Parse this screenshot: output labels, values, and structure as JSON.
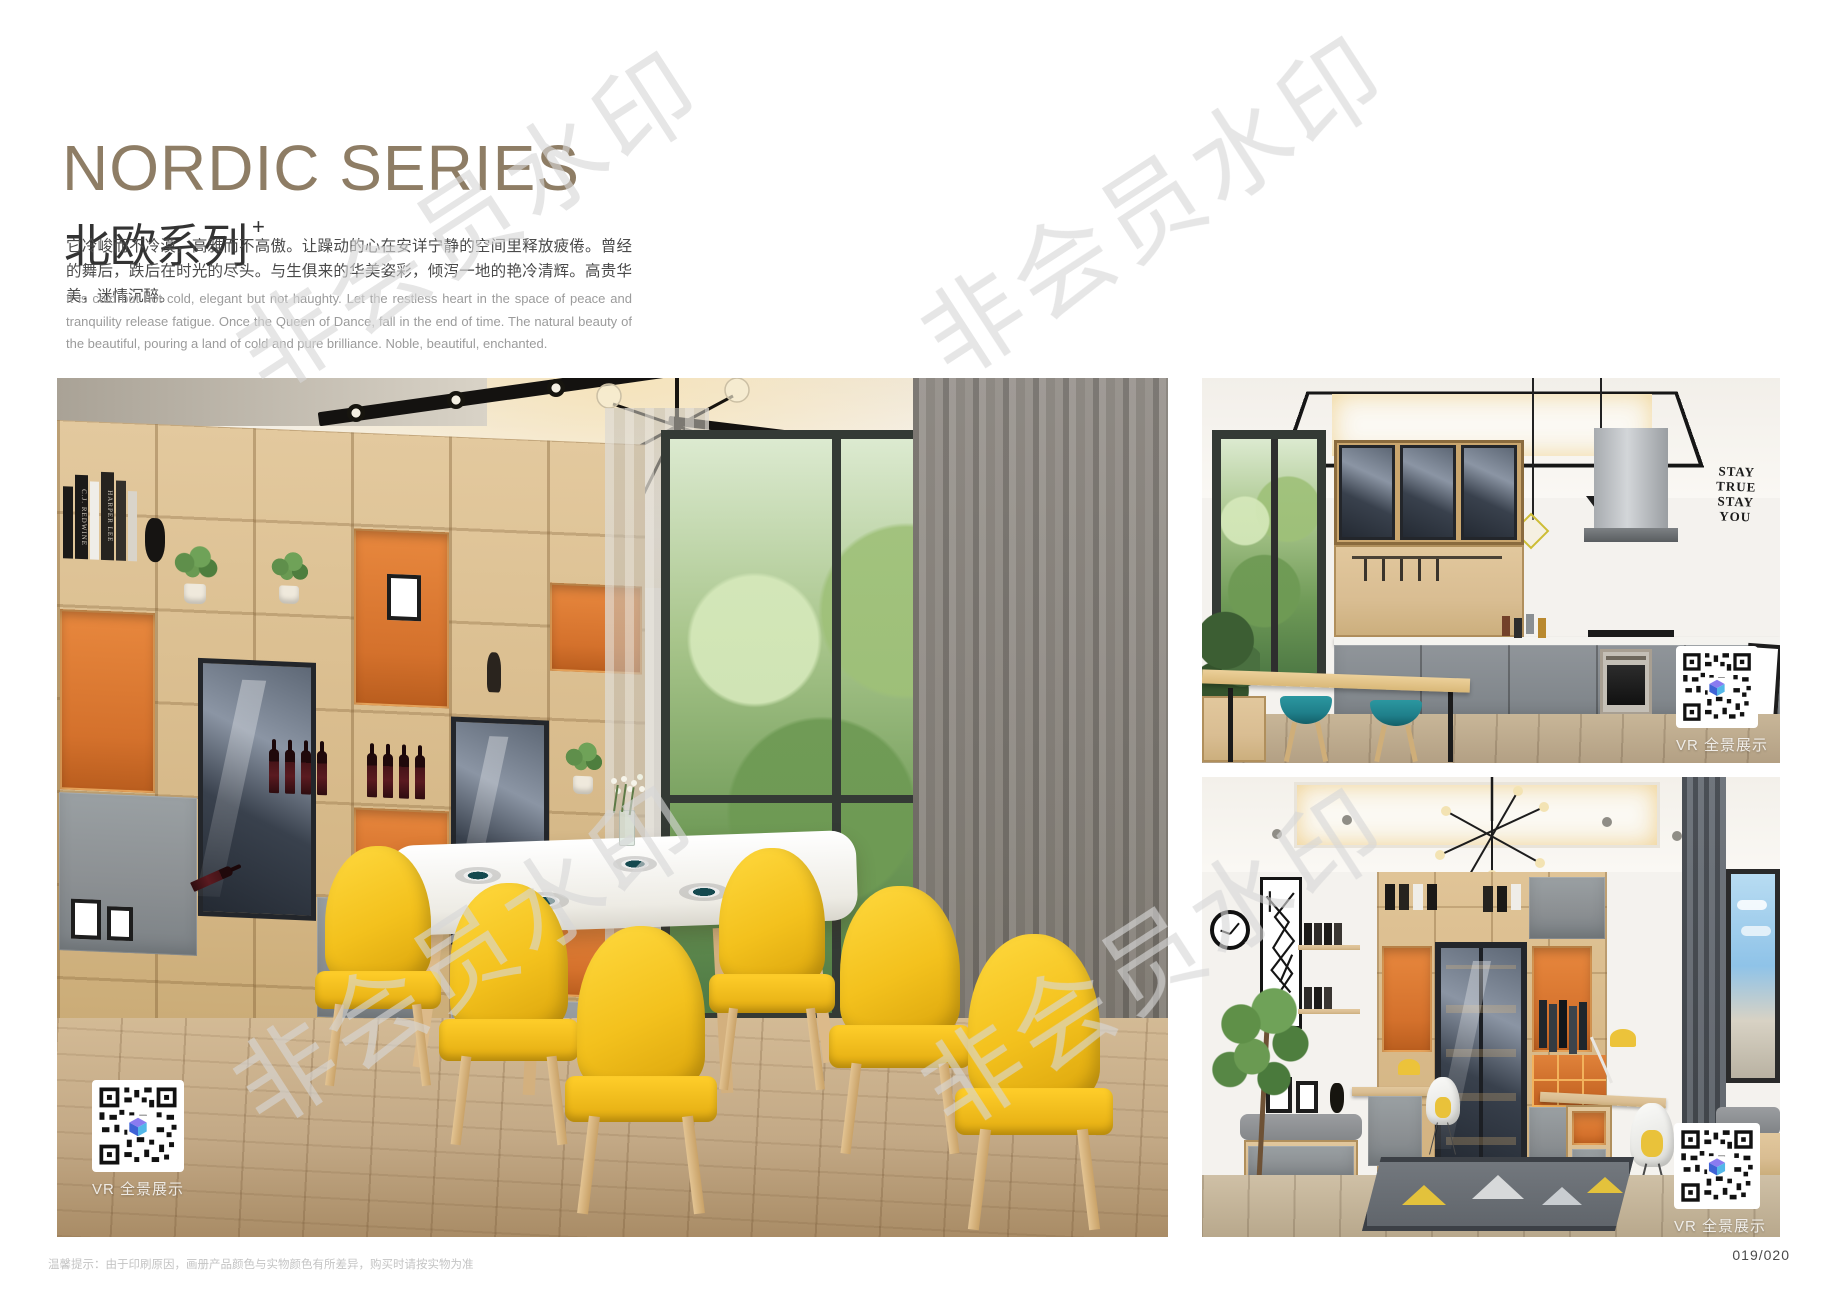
{
  "page": {
    "title_en": "NORDIC SERIES",
    "title_cn": "北欧系列",
    "title_superscript": "+",
    "intro_cn": "它冷峻而不冷漠，高雅而不高傲。让躁动的心在安详宁静的空间里释放疲倦。曾经的舞后，跌后在时光的尽头。与生俱来的华美姿彩，倾泻一地的艳冷清辉。高贵华美，迷情沉醉。",
    "intro_en": "It is cold but not cold, elegant but not haughty. Let the restless heart in the space of peace and tranquility release fatigue. Once the Queen of Dance, fall in the end of time. The natural beauty of the beautiful, pouring a land of cold and pure brilliance. Noble, beautiful, enchanted.",
    "footer_note": "温馨提示：由于印刷原因，画册产品颜色与实物颜色有所差异，购买时请按实物为准",
    "page_number": "019/020",
    "watermark_text": "非会员水印"
  },
  "photos": {
    "dining": {
      "vr_label": "VR 全景展示",
      "books": [
        "C.J. REDWINE",
        "HARPER LEE"
      ]
    },
    "kitchen": {
      "vr_label": "VR 全景展示",
      "wall_art_lines": [
        "STAY",
        "TRUE",
        "STAY",
        "YOU"
      ]
    },
    "study": {
      "vr_label": "VR 全景展示"
    }
  },
  "colors": {
    "title_text": "#8e7d65",
    "heading_text": "#333333",
    "body_text": "#4a4a4a",
    "body_text_light": "#9b9b9b",
    "footer_text": "#c4c4c4",
    "page_number_text": "#4a4a4a",
    "accent_orange": "#d4712c",
    "oak_wood": "#d9bd92",
    "cabinet_gray": "#8c9093",
    "chair_yellow": "#f3c11d",
    "stool_teal": "#1f7f8a",
    "floor_wood": "#c3a986",
    "qr_logo_blue": "#4a63d8"
  }
}
